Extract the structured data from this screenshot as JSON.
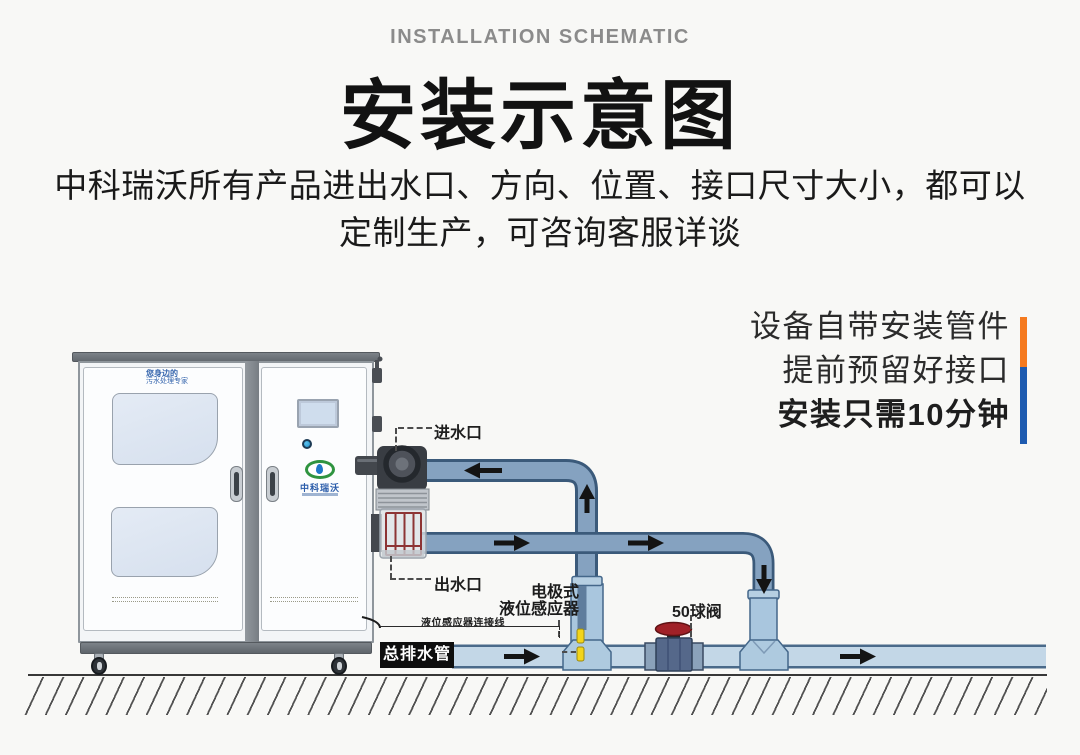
{
  "header": {
    "subtitle_en": "INSTALLATION SCHEMATIC",
    "title": "安装示意图",
    "description": {
      "line1": "中科瑞沃所有产品进出水口、方向、位置、接口尺寸大小，都可以",
      "line2": "定制生产，可咨询客服详谈"
    }
  },
  "promo": {
    "lines": [
      "设备自带安装管件",
      "提前预留好接口",
      "安装只需10分钟"
    ]
  },
  "machine": {
    "tagline_line1": "您身边的",
    "tagline_line2": "污水处理专家",
    "logo_text": "中科瑞沃"
  },
  "diagram_labels": {
    "water_inlet": "进水口",
    "water_outlet": "出水口",
    "sensor_type": "电极式",
    "sensor_name": "液位感应器",
    "sensor_cable": "液位感应器连接线",
    "ball_valve": "50球阀",
    "main_drain_pipe": "总排水管"
  },
  "colors": {
    "accent_orange": "#f57a1f",
    "accent_blue": "#1e5bb0",
    "pipe_dark_fill": "#85a2c0",
    "pipe_dark_outline": "#3b5a7a",
    "pipe_light_fill": "#c3d7e7",
    "pipe_light_outline": "#4a6a8a",
    "fitting_fill": "#a9c6de",
    "electrode_yellow": "#f3d41b",
    "valve_handle_red": "#a02127",
    "arrow_black": "#141414"
  }
}
